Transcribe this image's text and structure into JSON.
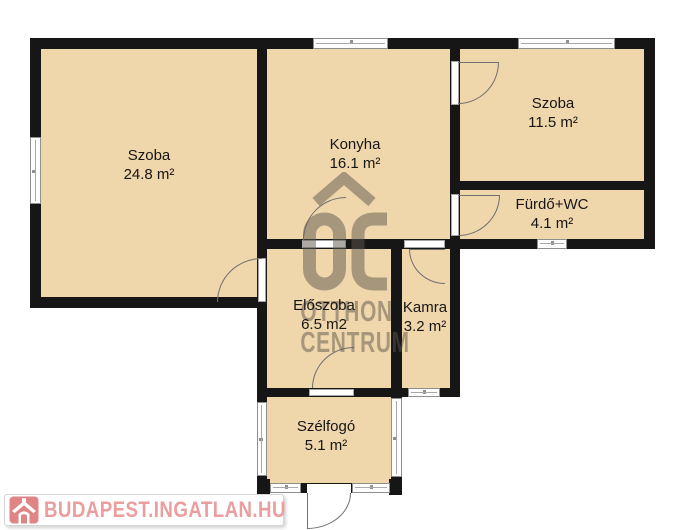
{
  "colors": {
    "floor": "#efd6ab",
    "wall": "#161616",
    "window-frame": "#8f8f8f",
    "door-arc": "#707070",
    "watermark": "#5f584e",
    "logo-pink": "#eb9e9e",
    "logo-icon-pink": "#df8585"
  },
  "floorplan": {
    "rooms": [
      {
        "name": "Szoba",
        "area": "24.8 m²"
      },
      {
        "name": "Konyha",
        "area": "16.1 m²"
      },
      {
        "name": "Szoba",
        "area": "11.5 m²"
      },
      {
        "name": "Fürdő+WC",
        "area": "4.1 m²"
      },
      {
        "name": "Előszoba",
        "area": "6.5 m2"
      },
      {
        "name": "Kamra",
        "area": "3.2 m²"
      },
      {
        "name": "Szélfogó",
        "area": "5.1 m²"
      }
    ]
  },
  "watermark": {
    "monogram": "OC",
    "line1": "OTTHON",
    "line2": "CENTRUM"
  },
  "footer_logo": {
    "text": "BUDAPEST.INGATLAN.HU"
  }
}
